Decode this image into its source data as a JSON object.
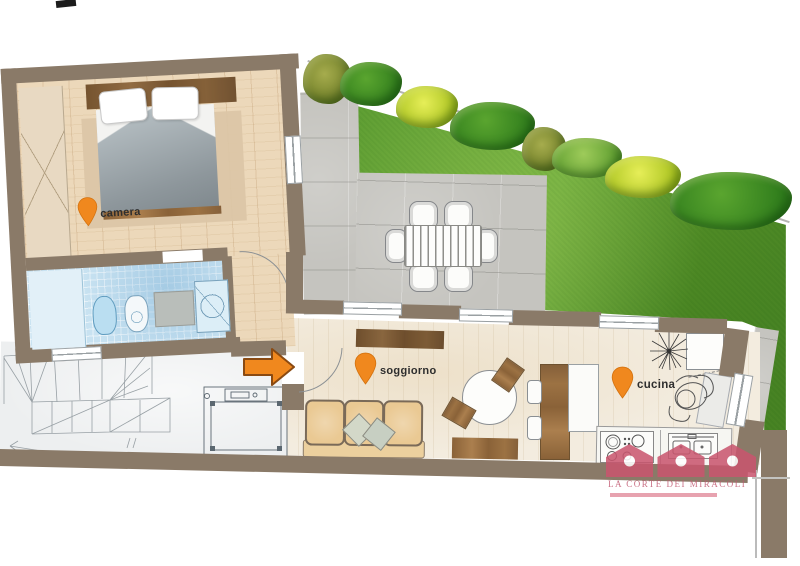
{
  "document": {
    "type": "floor-plan-scan",
    "style": "rendered top-view apartment plan with garden"
  },
  "labels": {
    "bedroom": "camera",
    "living": "soggiorno",
    "kitchen": "cucina"
  },
  "logo": {
    "text": "LA CORTE DEI MIRACOLI",
    "icon": "three-houses"
  },
  "icons": {
    "pin": "location-pin",
    "arrow": "entrance-arrow-right",
    "houses": "logo-houses"
  },
  "colors": {
    "wall": "#8a7a68",
    "orange": "#f0881e",
    "orange_dark": "#8a4a12",
    "logo_pink": "#c9556e",
    "logo_underline": "#e493a2",
    "grass": "#5f9e33",
    "hedge_green": "#3c8a26",
    "hedge_yellow": "#c9d92f",
    "tile_blue": "#c8e2f1",
    "wood_floor": "#ecd8ba",
    "living_floor": "#f3ecdf",
    "patio": "#c5c4bf",
    "neighbor": "#edeff0",
    "duvet": "#9aa2a7",
    "rug": "#dcc5a6",
    "sofa": "#eac993"
  }
}
